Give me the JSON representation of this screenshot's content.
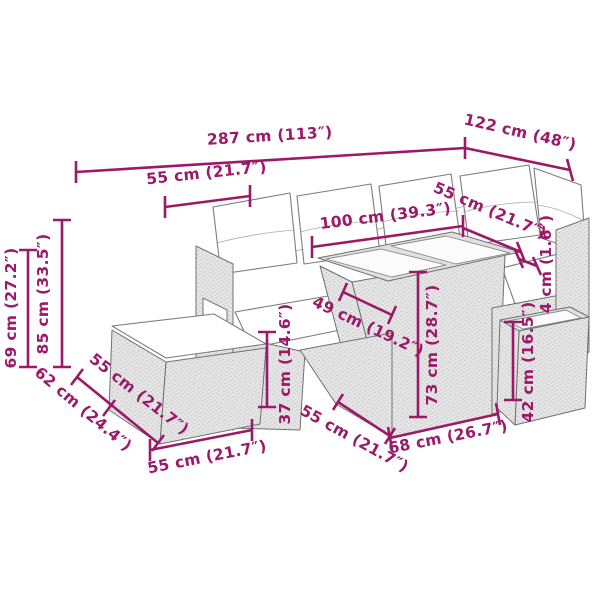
{
  "diagram": {
    "background_color": "#ffffff",
    "dimension_color": "#9b1968",
    "furniture_outline_color": "#707070",
    "rattan_fill_color": "#e7e7e7",
    "cushion_fill_color": "#ffffff",
    "dimensions": [
      {
        "id": "overall-width",
        "label": "287 cm (113″)"
      },
      {
        "id": "overall-depth",
        "label": "122 cm (48″)"
      },
      {
        "id": "seat-width-top",
        "label": "55 cm (21.7″)"
      },
      {
        "id": "table-length",
        "label": "100 cm (39.3″)"
      },
      {
        "id": "right-seat-width",
        "label": "55 cm (21.7″)"
      },
      {
        "id": "glass-thickness",
        "label": "4 cm (1.6″)"
      },
      {
        "id": "arm-height",
        "label": "69 cm (27.2″)"
      },
      {
        "id": "total-height",
        "label": "85 cm (33.5″)"
      },
      {
        "id": "sofa-depth",
        "label": "62 cm (24.4″)"
      },
      {
        "id": "ottoman-depth",
        "label": "55 cm (21.7″)"
      },
      {
        "id": "ottoman-width",
        "label": "55 cm (21.7″)"
      },
      {
        "id": "ottoman-height",
        "label": "37 cm (14.6″)"
      },
      {
        "id": "table-depth",
        "label": "49 cm (19.2″)"
      },
      {
        "id": "mid-seat-depth",
        "label": "55 cm (21.7″)"
      },
      {
        "id": "table-width",
        "label": "68 cm (26.7″)"
      },
      {
        "id": "table-height",
        "label": "73 cm (28.7″)"
      },
      {
        "id": "side-table-height",
        "label": "42 cm (16.5″)"
      }
    ]
  }
}
